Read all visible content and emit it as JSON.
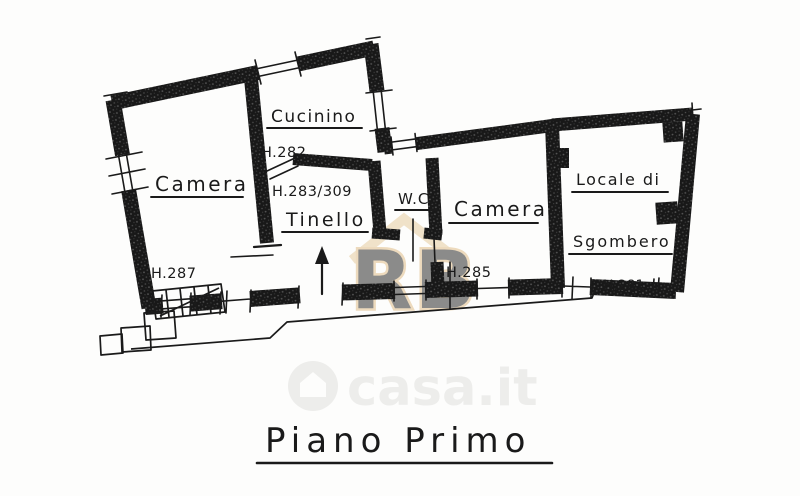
{
  "title": "Piano Primo",
  "labels": {
    "camera_left": "Camera",
    "cucinino": "Cucinino",
    "tinello": "Tinello",
    "wc": "W.C.",
    "camera_right": "Camera",
    "locale_line1": "Locale di",
    "locale_line2": "Sgombero"
  },
  "heights": {
    "h282": "H.282",
    "h283": "H.283/309",
    "h287": "H.287",
    "h285": "H.285",
    "h281": "H.281"
  },
  "watermarks": {
    "casa": "casa.it",
    "logo": "RB"
  },
  "colors": {
    "ink": "#1a1a1a",
    "paper": "#fdfdfc",
    "casa_gray": "#ededeb",
    "logo_blue": "#7397c2",
    "logo_tan": "#dfba80"
  }
}
